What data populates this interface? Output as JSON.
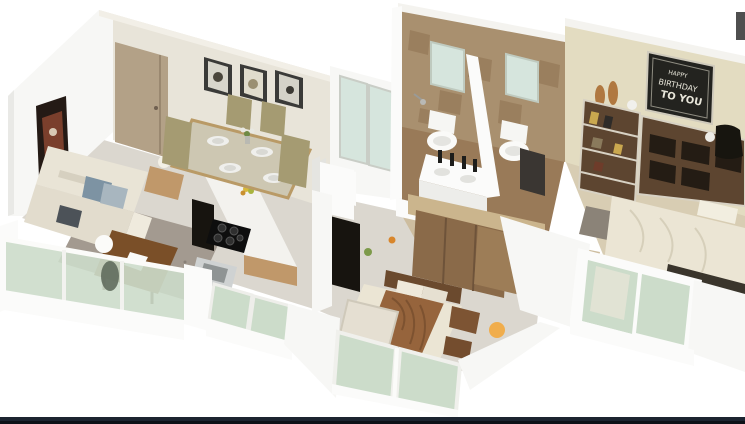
{
  "scene": {
    "type": "3d-isometric-floor-plan-render",
    "rooms": [
      "living-room",
      "dining-area",
      "kitchen",
      "entry-foyer",
      "bathroom-1",
      "bathroom-2",
      "corridor",
      "bedroom-2",
      "master-bedroom",
      "living-balcony"
    ],
    "furniture": [
      "sofa",
      "coffee-table",
      "dining-table",
      "dining-chairs",
      "kitchen-island",
      "gas-hob",
      "sink",
      "fridge",
      "toilets",
      "washbasin",
      "wardrobe",
      "beds",
      "bookshelf",
      "sideboard",
      "tv-panels",
      "table-lamp"
    ]
  },
  "artwork": {
    "chalkboard": {
      "line1": "HAPPY",
      "line2": "BIRTHDAY",
      "line3": "TO YOU"
    }
  },
  "colors": {
    "background": "#ffffff",
    "outer_wall": "#f7f7f5",
    "outer_wall_shade": "#e9e9e6",
    "wall_cream": "#e8e4d9",
    "wall_beige": "#e3dcc1",
    "wall_bath_brown": "#a9906f",
    "floor_marble": "#dbd7cf",
    "floor_bath": "#997a58",
    "floor_corridor": "#cdbd9f",
    "floor_master": "#d8cdb3",
    "glass_green": "#ccdcca",
    "glass_frost": "#d6e5dd",
    "wood_door": "#b3a187",
    "wood_table": "#c0986a",
    "wood_dark": "#7a4f28",
    "wood_shelf": "#5d4530",
    "wardrobe": "#8a6a49",
    "wardrobe_light": "#9d7d57",
    "sofa": "#e9e4d6",
    "bed_blanket": "#96643c",
    "bed_cream": "#ebe5d4",
    "tv_black": "#17140f",
    "chalkboard": "#23231f",
    "chalk_text": "#e8e6da",
    "rug_gray": "#a39a90",
    "chair_olive": "#a59b72",
    "accent_glow": "#f2a93d",
    "bottom_bar": "#1c2430",
    "bottom_bar_dark": "#0d1118",
    "corner_notch": "#4f4f4f",
    "white": "#fbfbfa"
  }
}
